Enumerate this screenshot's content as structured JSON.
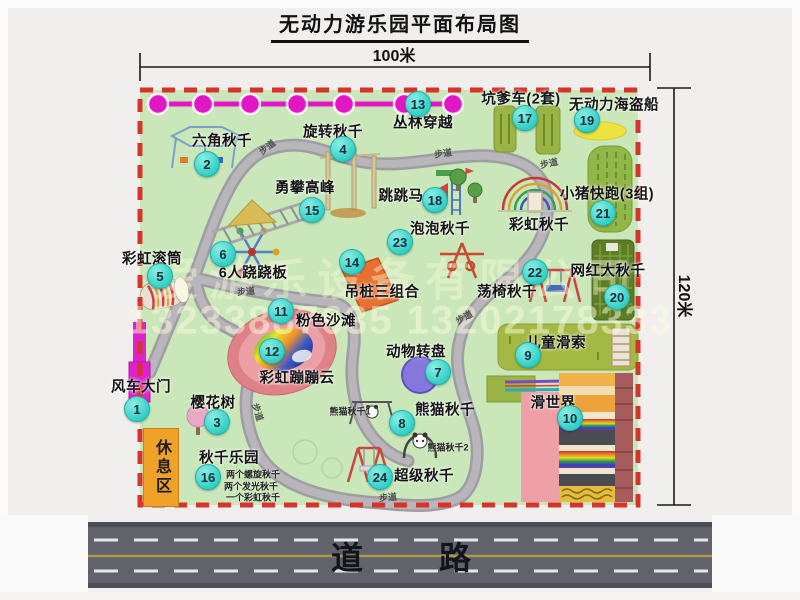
{
  "title": "无动力游乐园平面布局图",
  "dimensions": {
    "width": "100米",
    "height": "120米"
  },
  "watermark": {
    "company": "爱游乐设备有限公司",
    "phones": "13233887635 13202178333"
  },
  "road_label": "道　路",
  "rest_area_label": "休息区",
  "walkway_label": "步道",
  "attractions": [
    {
      "num": "1",
      "name": "风车大门"
    },
    {
      "num": "2",
      "name": "六角秋千"
    },
    {
      "num": "3",
      "name": "樱花树"
    },
    {
      "num": "4",
      "name": "旋转秋千"
    },
    {
      "num": "5",
      "name": "彩虹滚筒"
    },
    {
      "num": "6",
      "name": "6人跷跷板"
    },
    {
      "num": "7",
      "name": "动物转盘"
    },
    {
      "num": "8",
      "name": "熊猫秋千"
    },
    {
      "num": "9",
      "name": "儿童滑索"
    },
    {
      "num": "10",
      "name": "滑世界"
    },
    {
      "num": "11",
      "name": "粉色沙滩"
    },
    {
      "num": "12",
      "name": "彩虹蹦蹦云"
    },
    {
      "num": "13",
      "name": "丛林穿越"
    },
    {
      "num": "14",
      "name": "吊桩三组合"
    },
    {
      "num": "15",
      "name": "勇攀高峰"
    },
    {
      "num": "16",
      "name": "秋千乐园"
    },
    {
      "num": "17",
      "name": "坑爹车(2套)"
    },
    {
      "num": "18",
      "name": "跳跳马"
    },
    {
      "num": "19",
      "name": "无动力海盗船"
    },
    {
      "num": "20",
      "name": "网红大秋千"
    },
    {
      "num": "21",
      "name": "小猪快跑(3组)"
    },
    {
      "num": "22",
      "name": "荡椅秋千"
    },
    {
      "num": "23",
      "name": "泡泡秋千"
    },
    {
      "num": "24",
      "name": "超级秋千"
    }
  ],
  "extra_labels": {
    "rainbow_swing": "彩虹秋千",
    "panda_swing_1": "熊猫秋千1",
    "panda_swing_2": "熊猫秋千2",
    "swing_park_notes": [
      "两个螺旋秋千",
      "两个发光秋千",
      "一个彩虹秋千"
    ]
  },
  "colors": {
    "park_green": "#c9e7b8",
    "border_red": "#d5342a",
    "marker_teal": "#2fcfc5",
    "chain_magenta": "#e316c5",
    "rest_area_orange": "#f0a128",
    "road_gray": "#62626c"
  }
}
